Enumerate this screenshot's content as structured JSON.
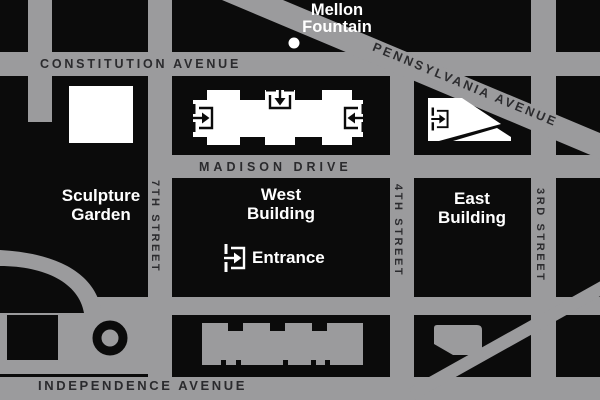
{
  "title": "National Gallery of Art area map",
  "colors": {
    "background_block": "#0b0b0b",
    "street_gray": "#9b9b9d",
    "street_label": "#2b2b2e",
    "building_white": "#ffffff",
    "label_white": "#ffffff"
  },
  "streets": {
    "constitution": "CONSTITUTION AVENUE",
    "pennsylvania": "PENNSYLVANIA AVENUE",
    "madison": "MADISON DRIVE",
    "independence": "INDEPENDENCE AVENUE",
    "seventh": "7TH STREET",
    "fourth": "4TH STREET",
    "third": "3RD STREET"
  },
  "landmarks": {
    "mellon": {
      "line1": "Mellon",
      "line2": "Fountain"
    },
    "sculpture": {
      "line1": "Sculpture",
      "line2": "Garden"
    },
    "west": {
      "line1": "West",
      "line2": "Building"
    },
    "east": {
      "line1": "East",
      "line2": "Building"
    },
    "entrance_label": "Entrance"
  },
  "icons": {
    "west_building_west_entrance": "enter-right-icon",
    "west_building_north_entrance": "enter-down-icon",
    "west_building_east_entrance": "enter-left-icon",
    "east_building_entrance": "enter-right-icon",
    "legend_entrance": "enter-right-icon",
    "mellon_fountain_marker": "fountain-dot-icon"
  }
}
